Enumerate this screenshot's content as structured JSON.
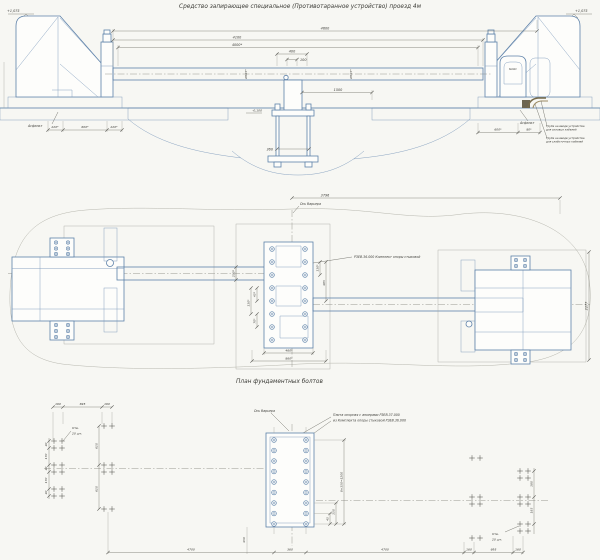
{
  "title": "Средство запирающее специальное (Противотаранное устройство) проезд 4м",
  "colors": {
    "line": "#5d81a9",
    "pipe": "#776a49",
    "paper": "#f7f7f3",
    "dim_text": "#3b3b36"
  },
  "elevation": {
    "level_left": "+1,075",
    "level_right": "+1,075",
    "level_base": "-0,100",
    "dim_total": "4600",
    "dim_span": "4100",
    "dim_clear": "4000*",
    "dim_400": "400",
    "dim_100": "100",
    "dim_1500": "1500",
    "dim_360": "360",
    "boom_dia": "Ø325*",
    "asphalt": "Асфальт",
    "dim_left_1": "220*",
    "dim_left_2": "600*",
    "dim_left_3": "220*",
    "dim_right_1": "600*",
    "dim_right_2": "80*",
    "pipe_note1_line1": "Труба на вводе устройства",
    "pipe_note1_line2": "для силовых кабелей",
    "pipe_note2_line1": "Труба на вводе устройства",
    "pipe_note2_line2": "для слаботочных кабелей",
    "cabinet_label": "БиОАС"
  },
  "plan": {
    "axis_label": "Ось барьера",
    "dim_3796": "3796",
    "support_note": "РЗЕВ.36.000 Комплект опоры стыковой",
    "dim_2277": "2277",
    "dim_250": "250*",
    "dim_460": "460*",
    "dim_860": "860*",
    "dim_110": "110*",
    "dim_485": "485",
    "dim_45": "45*",
    "dim_70": "70*"
  },
  "bolt_plan": {
    "title": "План фундаментных болтов",
    "axis_label": "Ось барьера",
    "note_line1": "Плита опорная с анкерами РЗЕВ.37.000",
    "note_line2": "из Комплекта опоры стыковой РЗЕВ.36.000",
    "holes_note_line1": "Отв.",
    "holes_note_line2": "20 шт.",
    "dim_160": "160",
    "dim_695": "695",
    "dim_4700": "4700",
    "dim_360": "360",
    "dim_rows": "8×150=1200",
    "dim_45": "45",
    "dim_150": "150",
    "dim_610": "610",
    "dim_40": "40",
    "dim_170": "170",
    "dim_180": "180",
    "dim_185": "185",
    "dim_450": "450"
  }
}
